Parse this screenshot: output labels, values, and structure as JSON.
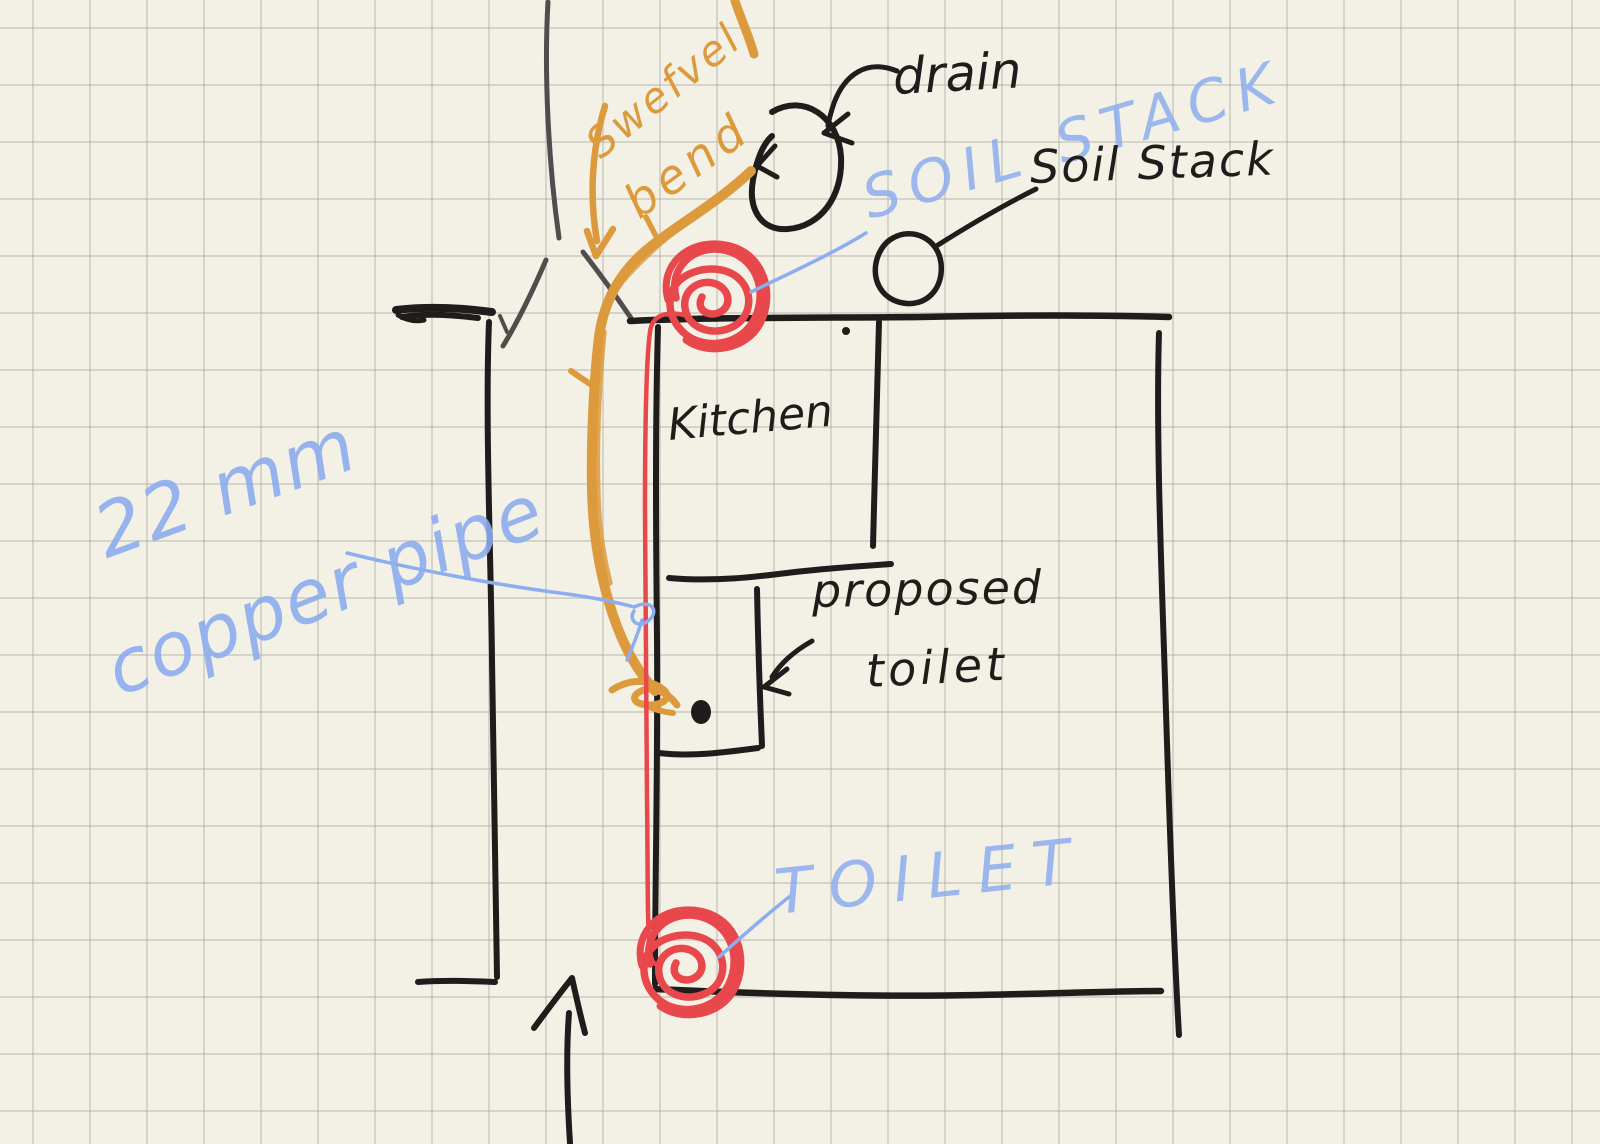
{
  "sketch": {
    "description": "hand-drawn plumbing floor-plan sketch on grid paper",
    "labels": {
      "swept_bend_line1": "Swefvel",
      "swept_bend_line2": "bend",
      "drain": "drain",
      "soil_stack_blue": "SOIL STACK",
      "soil_stack_black": "Soil Stack",
      "kitchen": "Kitchen",
      "proposed_line1": "proposed",
      "proposed_line2": "toilet",
      "pipe_size": "22 mm",
      "pipe_type": "copper pipe",
      "toilet_room": "TOILET"
    },
    "colors": {
      "paper": "#f3f1e5",
      "grid": "#d9d8d0",
      "ink_black": "#1e1d1b",
      "ink_gray": "#4f4e4c",
      "pipe_orange": "#dd9a3c",
      "marker_red": "#e8474c",
      "pencil_blue": "#8cadef"
    }
  }
}
